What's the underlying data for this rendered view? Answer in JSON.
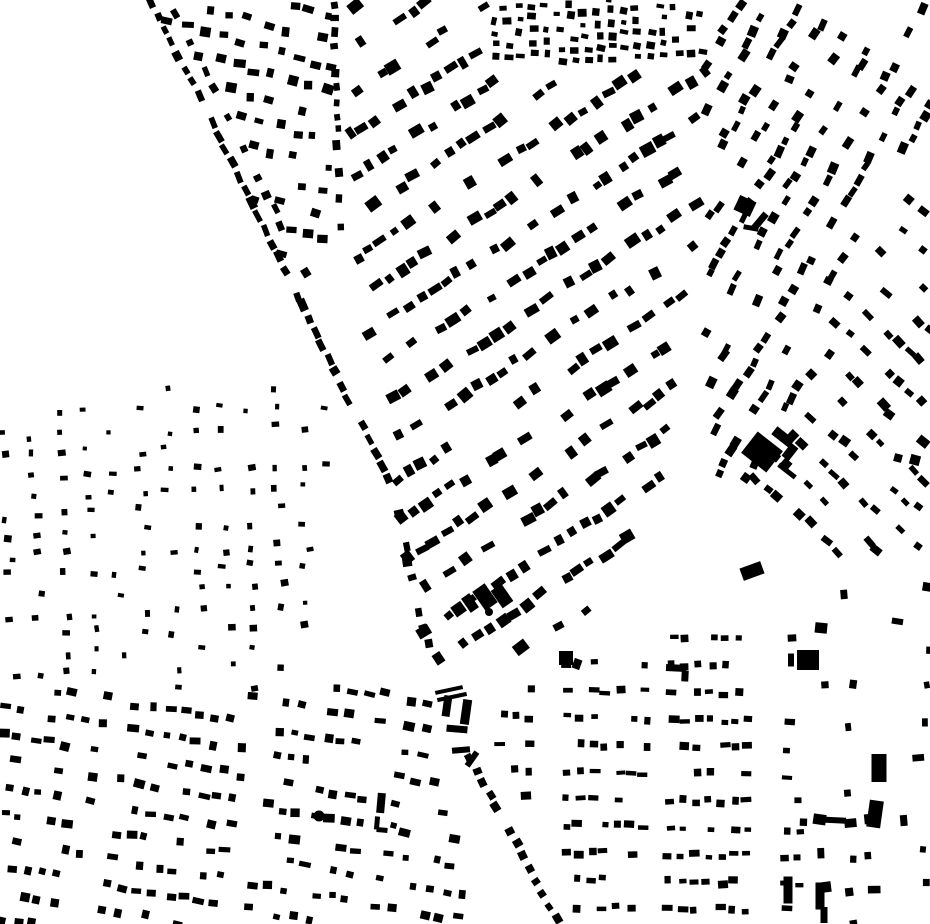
{
  "map": {
    "width": 930,
    "height": 924,
    "background_color": "#ffffff",
    "building_color": "#000000",
    "districts": [
      {
        "name": "wedge-north",
        "seed": 11,
        "polygon": [
          [
            155,
            0
          ],
          [
            333,
            0
          ],
          [
            333,
            252
          ],
          [
            302,
            307
          ]
        ],
        "angle": 16,
        "b_angle": 10,
        "row_spacing": 24,
        "unit_spacing": 19,
        "w_min": 6,
        "w_max": 12,
        "h_min": 5,
        "h_max": 10,
        "density": 0.74,
        "jitter": 7,
        "angle_jitter": 9,
        "block_len": 0,
        "block_gap": 0
      },
      {
        "name": "central-diagonal",
        "seed": 22,
        "polygon": [
          [
            350,
            0
          ],
          [
            492,
            0
          ],
          [
            492,
            62
          ],
          [
            712,
            62
          ],
          [
            706,
            195
          ],
          [
            650,
            552
          ],
          [
            560,
            645
          ],
          [
            468,
            662
          ],
          [
            434,
            688
          ],
          [
            388,
            478
          ],
          [
            350,
            258
          ]
        ],
        "angle": -33,
        "b_angle": -33,
        "row_spacing": 35,
        "unit_spacing": 15,
        "w_min": 7,
        "w_max": 14,
        "h_min": 6,
        "h_max": 12,
        "density": 0.8,
        "jitter": 6,
        "angle_jitter": 7,
        "block_len": 120,
        "block_gap": 20
      },
      {
        "name": "north-strip",
        "seed": 33,
        "polygon": [
          [
            492,
            0
          ],
          [
            712,
            0
          ],
          [
            712,
            62
          ],
          [
            492,
            62
          ]
        ],
        "angle": 85,
        "b_angle": 5,
        "row_spacing": 13,
        "unit_spacing": 12,
        "w_min": 5,
        "w_max": 9,
        "h_min": 4,
        "h_max": 8,
        "density": 0.82,
        "jitter": 4,
        "angle_jitter": 8,
        "block_len": 0,
        "block_gap": 0
      },
      {
        "name": "northeast-upper",
        "seed": 44,
        "polygon": [
          [
            708,
            0
          ],
          [
            930,
            0
          ],
          [
            930,
            155
          ],
          [
            818,
            350
          ],
          [
            748,
            480
          ],
          [
            700,
            480
          ],
          [
            706,
            62
          ]
        ],
        "angle": -60,
        "b_angle": -60,
        "row_spacing": 27,
        "unit_spacing": 13,
        "w_min": 7,
        "w_max": 12,
        "h_min": 5,
        "h_max": 9,
        "density": 0.72,
        "jitter": 6,
        "angle_jitter": 8,
        "block_len": 100,
        "block_gap": 16
      },
      {
        "name": "northeast-east",
        "seed": 55,
        "polygon": [
          [
            818,
            350
          ],
          [
            930,
            155
          ],
          [
            930,
            560
          ],
          [
            812,
            560
          ],
          [
            748,
            480
          ]
        ],
        "angle": 42,
        "b_angle": 42,
        "row_spacing": 28,
        "unit_spacing": 14,
        "w_min": 7,
        "w_max": 12,
        "h_min": 5,
        "h_max": 9,
        "density": 0.72,
        "jitter": 6,
        "angle_jitter": 8,
        "block_len": 95,
        "block_gap": 15
      },
      {
        "name": "west-sparse",
        "seed": 66,
        "polygon": [
          [
            0,
            388
          ],
          [
            330,
            388
          ],
          [
            330,
            690
          ],
          [
            0,
            690
          ]
        ],
        "angle": 88,
        "b_angle": 0,
        "row_spacing": 27,
        "unit_spacing": 20,
        "w_min": 4,
        "w_max": 8,
        "h_min": 4,
        "h_max": 7,
        "density": 0.58,
        "jitter": 9,
        "angle_jitter": 10,
        "block_len": 0,
        "block_gap": 0
      },
      {
        "name": "southwest",
        "seed": 77,
        "polygon": [
          [
            0,
            692
          ],
          [
            300,
            682
          ],
          [
            432,
            690
          ],
          [
            468,
            924
          ],
          [
            0,
            924
          ]
        ],
        "angle": 10,
        "b_angle": 8,
        "row_spacing": 26,
        "unit_spacing": 16,
        "w_min": 6,
        "w_max": 12,
        "h_min": 5,
        "h_max": 9,
        "density": 0.76,
        "jitter": 6,
        "angle_jitter": 7,
        "block_len": 130,
        "block_gap": 16
      },
      {
        "name": "south-central",
        "seed": 88,
        "polygon": [
          [
            558,
            650
          ],
          [
            802,
            618
          ],
          [
            802,
            920
          ],
          [
            575,
            920
          ],
          [
            500,
            755
          ],
          [
            498,
            690
          ]
        ],
        "angle": 1,
        "b_angle": 0,
        "row_spacing": 27,
        "unit_spacing": 13,
        "w_min": 6,
        "w_max": 11,
        "h_min": 4,
        "h_max": 8,
        "density": 0.7,
        "jitter": 5,
        "angle_jitter": 4,
        "block_len": 110,
        "block_gap": 16
      },
      {
        "name": "southeast-scatter",
        "seed": 99,
        "polygon": [
          [
            802,
            560
          ],
          [
            930,
            560
          ],
          [
            930,
            924
          ],
          [
            802,
            924
          ]
        ],
        "angle": 0,
        "b_angle": 0,
        "row_spacing": 33,
        "unit_spacing": 25,
        "w_min": 5,
        "w_max": 13,
        "h_min": 5,
        "h_max": 11,
        "density": 0.42,
        "jitter": 12,
        "angle_jitter": 10,
        "block_len": 0,
        "block_gap": 0
      }
    ],
    "street_chains": [
      {
        "name": "avenue-west-upper",
        "seed": 101,
        "from": [
          152,
          2
        ],
        "to": [
          302,
          305
        ],
        "spacing": 15,
        "w": 10,
        "h": 7,
        "density": 0.85,
        "jitter": 3
      },
      {
        "name": "avenue-west-mid",
        "seed": 102,
        "from": [
          302,
          305
        ],
        "to": [
          390,
          483
        ],
        "spacing": 15,
        "w": 10,
        "h": 7,
        "density": 0.85,
        "jitter": 3
      },
      {
        "name": "avenue-east-upper",
        "seed": 103,
        "from": [
          176,
          12
        ],
        "to": [
          318,
          298
        ],
        "spacing": 17,
        "w": 8,
        "h": 7,
        "density": 0.7,
        "jitter": 4
      },
      {
        "name": "wedge-east-street",
        "seed": 104,
        "from": [
          333,
          4
        ],
        "to": [
          341,
          232
        ],
        "spacing": 14,
        "w": 8,
        "h": 7,
        "density": 0.85,
        "jitter": 3
      },
      {
        "name": "avenue-low-upper",
        "seed": 105,
        "from": [
          394,
          495
        ],
        "to": [
          438,
          692
        ],
        "spacing": 17,
        "w": 8,
        "h": 8,
        "density": 0.7,
        "jitter": 4
      },
      {
        "name": "avenue-low-south",
        "seed": 106,
        "from": [
          470,
          758
        ],
        "to": [
          558,
          922
        ],
        "spacing": 14,
        "w": 8,
        "h": 8,
        "density": 0.85,
        "jitter": 3
      }
    ],
    "landmarks": {
      "rects": [
        {
          "x": 762,
          "y": 452,
          "w": 32,
          "h": 27,
          "a": 38
        },
        {
          "x": 783,
          "y": 437,
          "w": 22,
          "h": 10,
          "a": 38
        },
        {
          "x": 790,
          "y": 452,
          "w": 9,
          "h": 16,
          "a": 38
        },
        {
          "x": 787,
          "y": 471,
          "w": 21,
          "h": 5,
          "a": 38
        },
        {
          "x": 485,
          "y": 597,
          "w": 15,
          "h": 23,
          "a": -35
        },
        {
          "x": 502,
          "y": 596,
          "w": 13,
          "h": 21,
          "a": -35
        },
        {
          "x": 470,
          "y": 603,
          "w": 10,
          "h": 17,
          "a": -35
        },
        {
          "x": 745,
          "y": 206,
          "w": 18,
          "h": 16,
          "a": 25
        },
        {
          "x": 760,
          "y": 221,
          "w": 7,
          "h": 19,
          "a": 40
        },
        {
          "x": 751,
          "y": 228,
          "w": 15,
          "h": 5,
          "a": 10
        },
        {
          "x": 808,
          "y": 660,
          "w": 22,
          "h": 20,
          "a": 0
        },
        {
          "x": 791,
          "y": 660,
          "w": 6,
          "h": 13,
          "a": 0
        },
        {
          "x": 676,
          "y": 668,
          "w": 20,
          "h": 7,
          "a": 3
        },
        {
          "x": 685,
          "y": 676,
          "w": 7,
          "h": 11,
          "a": 3
        },
        {
          "x": 831,
          "y": 820,
          "w": 30,
          "h": 6,
          "a": 3
        },
        {
          "x": 879,
          "y": 768,
          "w": 15,
          "h": 28,
          "a": 0
        },
        {
          "x": 875,
          "y": 814,
          "w": 14,
          "h": 27,
          "a": 8
        },
        {
          "x": 788,
          "y": 890,
          "w": 9,
          "h": 27,
          "a": 0
        },
        {
          "x": 820,
          "y": 896,
          "w": 9,
          "h": 27,
          "a": 0
        },
        {
          "x": 824,
          "y": 915,
          "w": 7,
          "h": 16,
          "a": 0
        },
        {
          "x": 449,
          "y": 690,
          "w": 28,
          "h": 4,
          "a": -12
        },
        {
          "x": 452,
          "y": 697,
          "w": 30,
          "h": 4,
          "a": -12
        },
        {
          "x": 447,
          "y": 706,
          "w": 8,
          "h": 21,
          "a": 8
        },
        {
          "x": 466,
          "y": 712,
          "w": 9,
          "h": 25,
          "a": 8
        },
        {
          "x": 457,
          "y": 729,
          "w": 21,
          "h": 7,
          "a": 5
        },
        {
          "x": 461,
          "y": 750,
          "w": 18,
          "h": 6,
          "a": -5
        },
        {
          "x": 472,
          "y": 759,
          "w": 6,
          "h": 17,
          "a": 35
        },
        {
          "x": 566,
          "y": 658,
          "w": 14,
          "h": 14,
          "a": 0
        },
        {
          "x": 577,
          "y": 664,
          "w": 8,
          "h": 10,
          "a": 20
        },
        {
          "x": 752,
          "y": 571,
          "w": 22,
          "h": 13,
          "a": -20
        },
        {
          "x": 381,
          "y": 803,
          "w": 8,
          "h": 20,
          "a": 5
        },
        {
          "x": 377,
          "y": 823,
          "w": 5,
          "h": 13,
          "a": 5
        },
        {
          "x": 382,
          "y": 830,
          "w": 11,
          "h": 5,
          "a": 5
        },
        {
          "x": 898,
          "y": 458,
          "w": 8,
          "h": 8,
          "a": 15
        },
        {
          "x": 915,
          "y": 460,
          "w": 10,
          "h": 10,
          "a": 15
        }
      ],
      "circles": [
        {
          "cx": 319,
          "cy": 816,
          "r": 5.5
        },
        {
          "cx": 489,
          "cy": 612,
          "r": 4
        }
      ]
    }
  }
}
